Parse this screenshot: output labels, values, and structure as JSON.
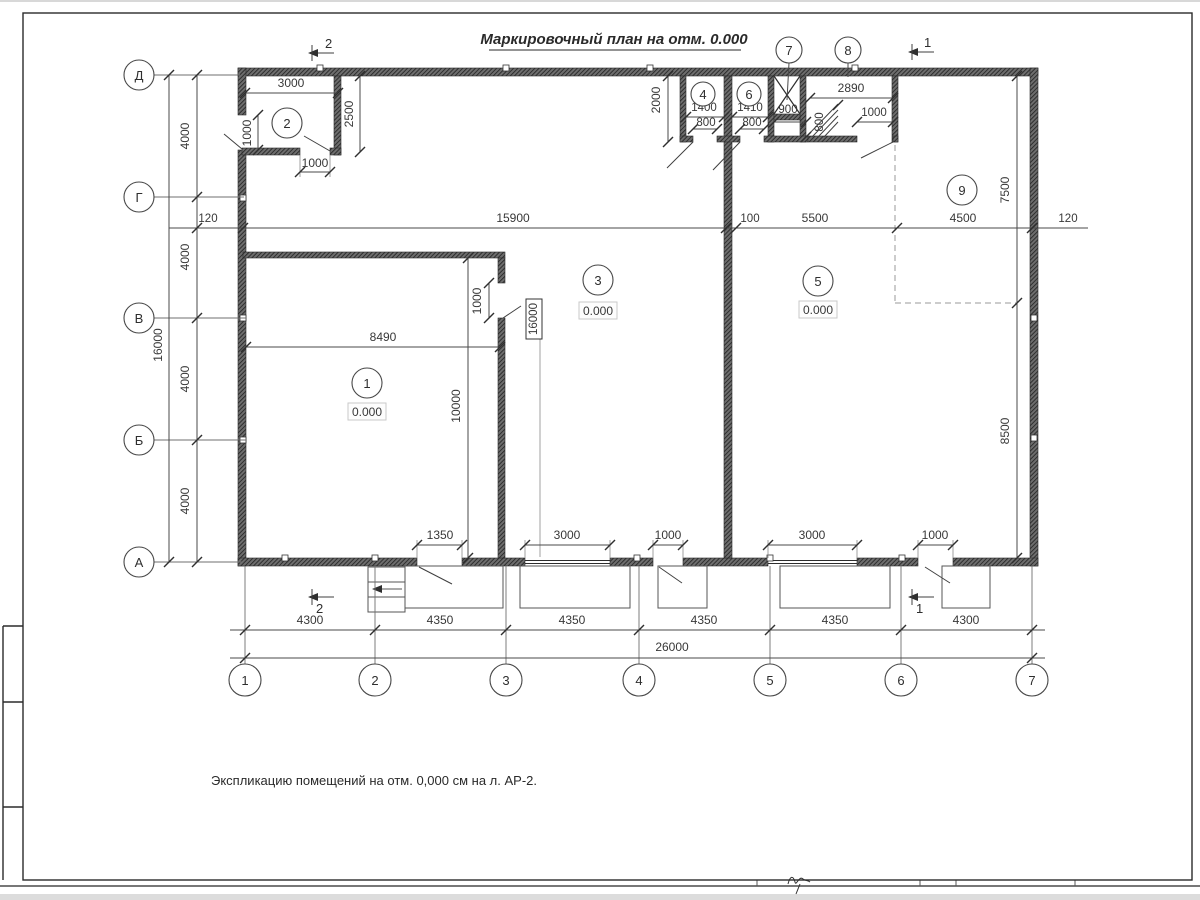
{
  "sheet": {
    "title": "Маркировочный план на отм. 0.000",
    "note": "Экспликацию помещений на отм. 0,000 см на л. АР-2."
  },
  "axes": {
    "rows": [
      "Д",
      "Г",
      "В",
      "Б",
      "А"
    ],
    "cols": [
      "1",
      "2",
      "3",
      "4",
      "5",
      "6",
      "7"
    ]
  },
  "rooms": {
    "r1": {
      "num": "1",
      "elev": "0.000"
    },
    "r2": {
      "num": "2"
    },
    "r3": {
      "num": "3",
      "elev": "0.000"
    },
    "r4": {
      "num": "4"
    },
    "r5": {
      "num": "5",
      "elev": "0.000"
    },
    "r6": {
      "num": "6"
    },
    "r7": {
      "num": "7"
    },
    "r8": {
      "num": "8"
    },
    "r9": {
      "num": "9"
    }
  },
  "sections": {
    "one": "1",
    "two": "2"
  },
  "dims": {
    "left_total": "16000",
    "left_bays": [
      "4000",
      "4000",
      "4000",
      "4000"
    ],
    "gamma_chain": [
      "120",
      "15900",
      "100",
      "5500",
      "4500",
      "120"
    ],
    "bottom_bays": [
      "4300",
      "4350",
      "4350",
      "4350",
      "4350",
      "4300"
    ],
    "bottom_total": "26000",
    "room2": {
      "width": "3000",
      "depth": "2500",
      "left_door": "1000",
      "bottom_door": "1000"
    },
    "room1": {
      "width": "8490",
      "depth": "10000",
      "door": "1000",
      "wall_tag": "16000",
      "entry": "1350"
    },
    "top_block": {
      "depth": "2000",
      "r4_width": "1400",
      "r4_door": "800",
      "r6_width": "1410",
      "r6_door": "800",
      "shaft_width": "900",
      "r8_width": "2890",
      "r8_door": "1000",
      "ramp": "800"
    },
    "right_side": {
      "upper": "7500",
      "lower": "8500"
    },
    "south_openings": [
      "3000",
      "1000",
      "3000",
      "1000"
    ]
  }
}
